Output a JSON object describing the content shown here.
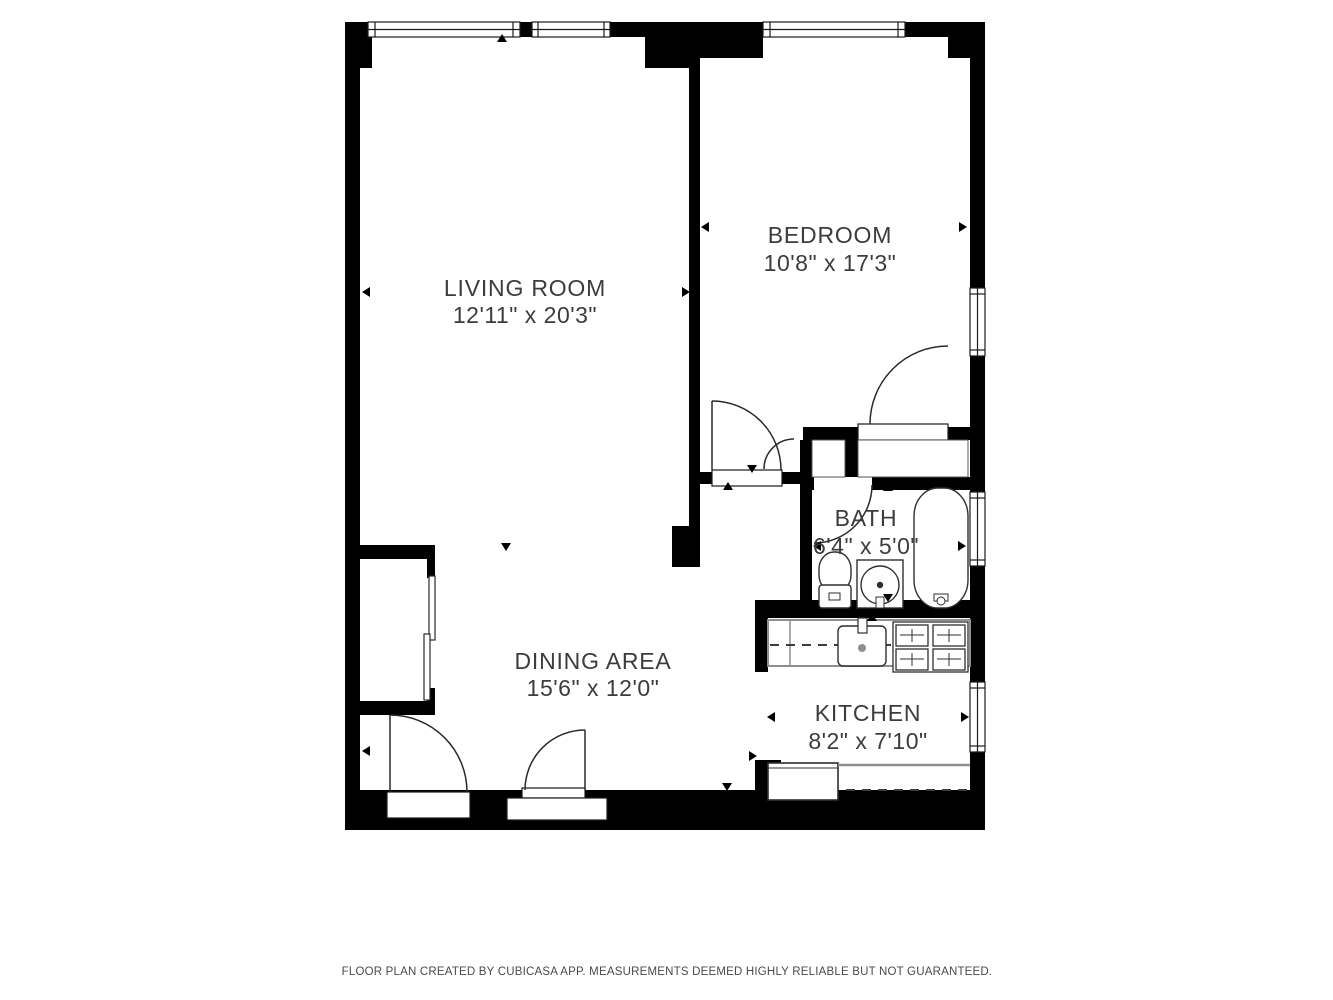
{
  "rooms": {
    "living": {
      "label": "LIVING ROOM",
      "dimensions": "12'11\" x 20'3\""
    },
    "bedroom": {
      "label": "BEDROOM",
      "dimensions": "10'8\" x 17'3\""
    },
    "bath": {
      "label": "BATH",
      "dimensions": "6'4\" x 5'0\""
    },
    "dining": {
      "label": "DINING AREA",
      "dimensions": "15'6\" x 12'0\""
    },
    "kitchen": {
      "label": "KITCHEN",
      "dimensions": "8'2\" x 7'10\""
    }
  },
  "footer": {
    "disclaimer": "FLOOR PLAN CREATED BY CUBICASA APP. MEASUREMENTS DEEMED HIGHLY RELIABLE BUT NOT GUARANTEED."
  },
  "colors": {
    "wall": "#000000",
    "text": "#3c3c3c",
    "counter": "#8f8f8f",
    "background": "#ffffff"
  }
}
